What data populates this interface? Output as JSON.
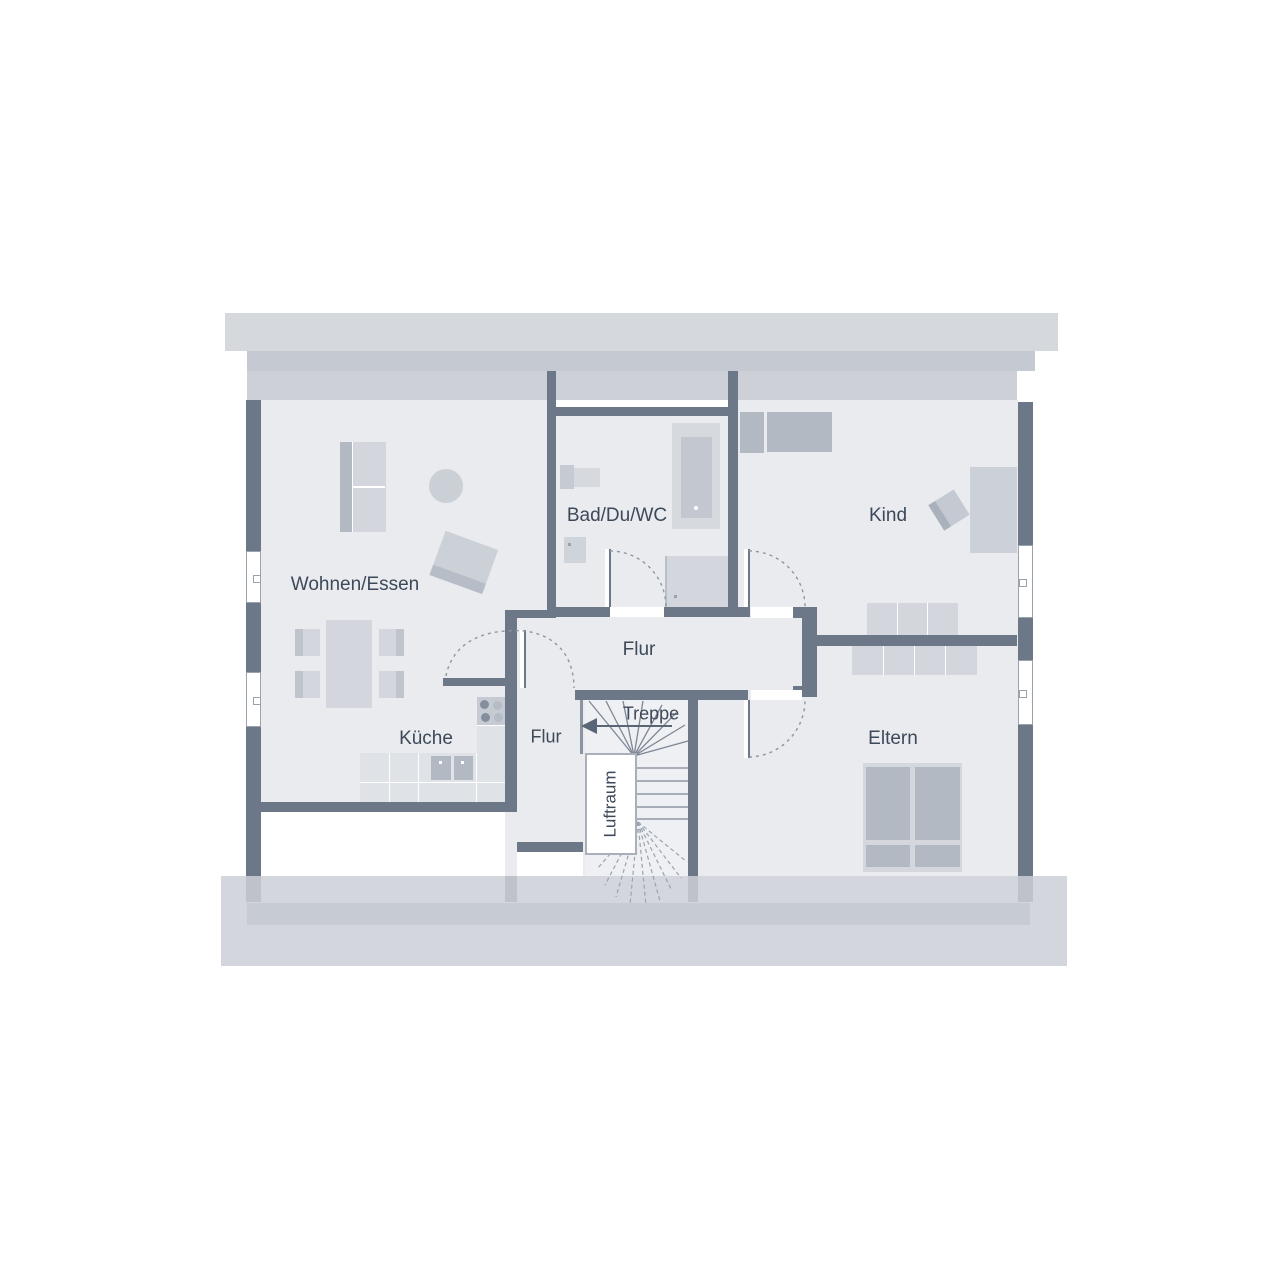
{
  "floorplan": {
    "type": "attic-floor-plan",
    "rooms": [
      {
        "id": "wohnen_essen",
        "label": "Wohnen/Essen"
      },
      {
        "id": "bad_du_wc",
        "label": "Bad/Du/WC"
      },
      {
        "id": "kind",
        "label": "Kind"
      },
      {
        "id": "flur_main",
        "label": "Flur"
      },
      {
        "id": "kueche",
        "label": "Küche"
      },
      {
        "id": "flur_lower",
        "label": "Flur"
      },
      {
        "id": "treppe",
        "label": "Treppe"
      },
      {
        "id": "eltern",
        "label": "Eltern"
      },
      {
        "id": "luftraum",
        "label": "Luftraum"
      }
    ],
    "colors": {
      "wall": "#6c7887",
      "room_fill": "#e9ebee",
      "roof_band_light": "#d5d8dd",
      "roof_band_medium": "#c5c9d1",
      "roof_band_soft": "#cdd0d6",
      "bottom_band": "#d3d6dc",
      "bottom_band_dark": "#c7cbd3",
      "furniture_light": "#d3d6dc",
      "furniture_medium": "#c6cad2",
      "furniture_dark": "#b3b9c3",
      "label_text": "#3d4959",
      "door_arc": "#8d96a2",
      "stair_line": "#7d8795"
    },
    "counts": {
      "windows": 4,
      "door_swings": 4,
      "rooms_labeled": 9
    },
    "stairs": {
      "direction_arrow": "left",
      "label": "Treppe"
    },
    "furniture_inventory": [
      "wardrobe",
      "coffee-table",
      "side-table",
      "dining-table",
      "dining-chair",
      "kitchen-counter",
      "cooktop",
      "sink",
      "washbasin",
      "bathtub",
      "wc",
      "shower",
      "single-bed",
      "desk",
      "desk-chair",
      "sideboard",
      "dresser",
      "double-bed"
    ]
  }
}
